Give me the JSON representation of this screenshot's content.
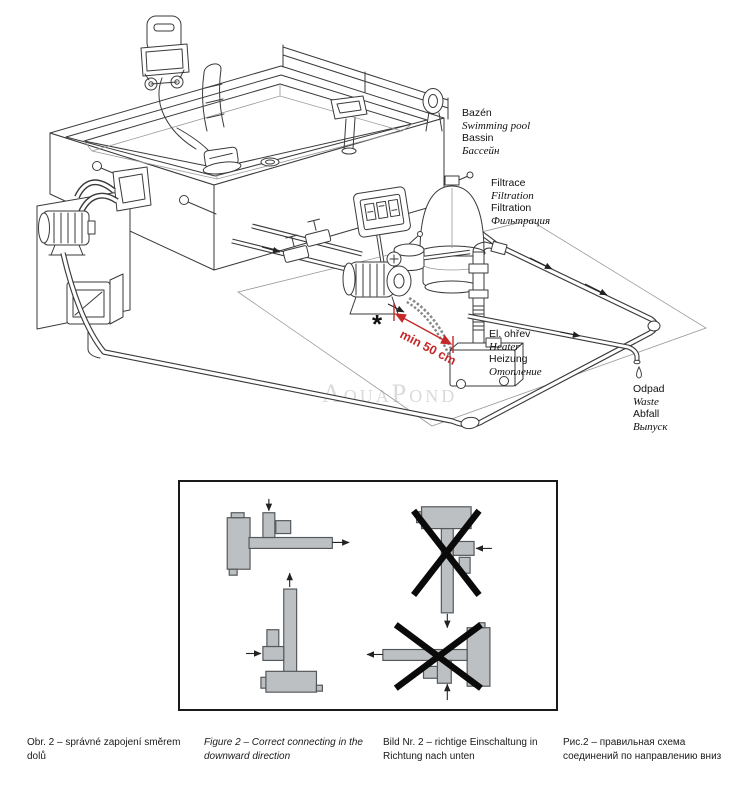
{
  "figure": {
    "watermark": "AquaPond",
    "labels": {
      "pool": {
        "lines": [
          {
            "text": "Bazén",
            "style": "regular"
          },
          {
            "text": "Swimming pool",
            "style": "italic"
          },
          {
            "text": "Bassin",
            "style": "regular"
          },
          {
            "text": "Бассейн",
            "style": "italic"
          }
        ]
      },
      "filtration": {
        "lines": [
          {
            "text": "Filtrace",
            "style": "regular"
          },
          {
            "text": "Filtration",
            "style": "italic"
          },
          {
            "text": "Filtration",
            "style": "regular"
          },
          {
            "text": "Фильтрация",
            "style": "italic"
          }
        ]
      },
      "heater": {
        "lines": [
          {
            "text": "El. ohřev",
            "style": "regular"
          },
          {
            "text": "Heater",
            "style": "italic"
          },
          {
            "text": "Heizung",
            "style": "regular"
          },
          {
            "text": "Отопление",
            "style": "italic"
          }
        ]
      },
      "waste": {
        "lines": [
          {
            "text": "Odpad",
            "style": "regular"
          },
          {
            "text": "Waste",
            "style": "italic"
          },
          {
            "text": "Abfall",
            "style": "regular"
          },
          {
            "text": "Выпуск",
            "style": "italic"
          }
        ]
      }
    },
    "annotation": {
      "asterisk": "*",
      "min_distance": "min 50 cm",
      "color": "#c62828"
    }
  },
  "figure_box": {
    "diagrams": [
      {
        "orientation": "horizontal",
        "status": "correct"
      },
      {
        "orientation": "vertical",
        "status": "correct"
      },
      {
        "orientation": "vertical",
        "status": "wrong"
      },
      {
        "orientation": "horizontal",
        "status": "wrong"
      }
    ]
  },
  "captions": {
    "cs": "Obr. 2 – správné zapojení směrem dolů",
    "en": "Figure 2 – Correct connecting in the downward direction",
    "de": "Bild Nr. 2 – richtige Einschaltung in Richtung nach unten",
    "ru": "Рис.2 – правильная схема соединений по направлению вниз"
  },
  "colors": {
    "annotation_red": "#c62828",
    "diagram_fill": "#bcc0c2",
    "cross_black": "#0a0a0a",
    "watermark_gray": "#dadada",
    "line_art": "#3a3a3a"
  }
}
